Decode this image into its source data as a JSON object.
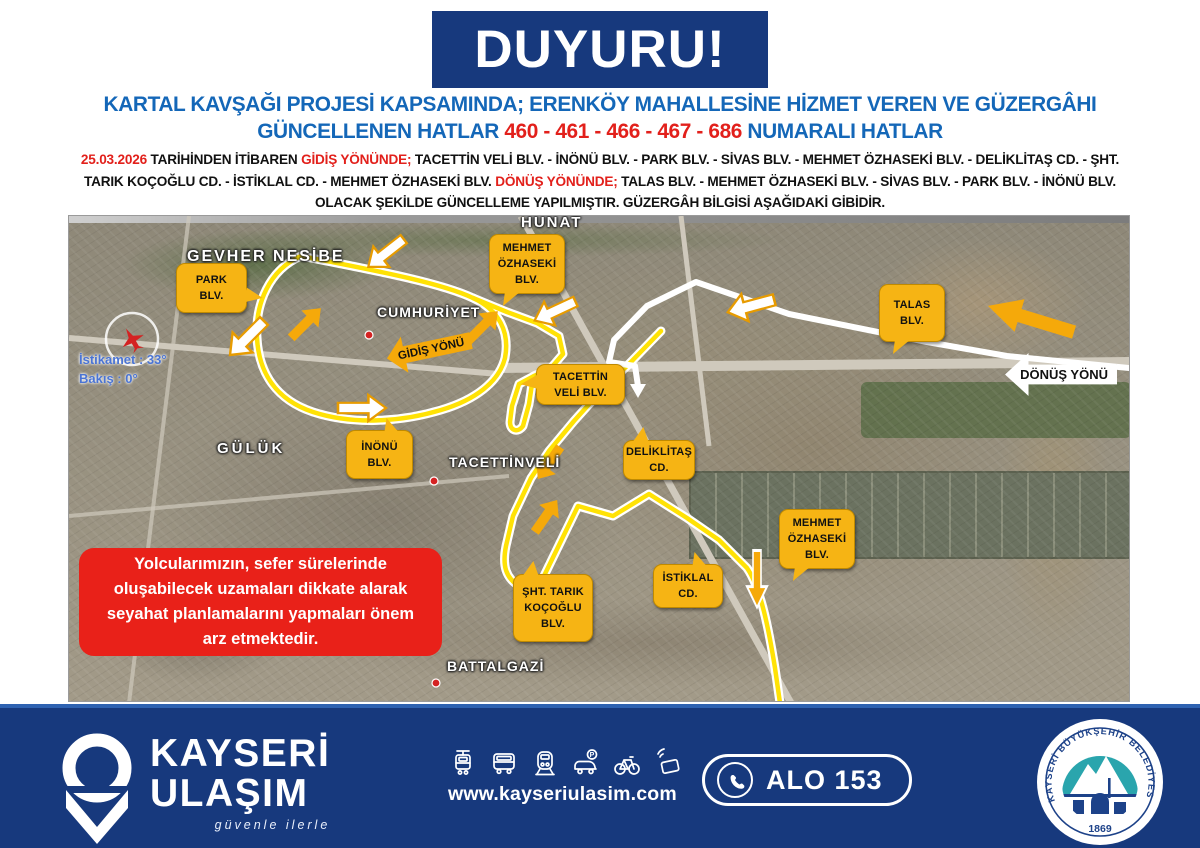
{
  "banner": {
    "title": "DUYURU!"
  },
  "headline": {
    "line1": "KARTAL KAVŞAĞI PROJESİ KAPSAMINDA; ERENKÖY MAHALLESİNE HİZMET VEREN VE GÜZERGÂHI",
    "line2_prefix": "GÜNCELLENEN HATLAR ",
    "line2_numbers": "460 - 461 - 466 - 467 - 686",
    "line2_suffix": " NUMARALI HATLAR"
  },
  "body": {
    "date": "25.03.2026",
    "seg_intro": " TARİHİNDEN İTİBAREN ",
    "gidis_label": "GİDİŞ YÖNÜNDE;",
    "gidis_route": " TACETTİN VELİ BLV. - İNÖNÜ BLV. - PARK BLV. - SİVAS BLV. - MEHMET ÖZHASEKİ BLV. - DELİKLİTAŞ CD. - ŞHT. TARIK KOÇOĞLU CD. - İSTİKLAL CD. - MEHMET ÖZHASEKİ BLV. ",
    "donus_label": "DÖNÜŞ YÖNÜNDE;",
    "donus_route": " TALAS BLV. - MEHMET ÖZHASEKİ BLV. - SİVAS BLV. - PARK BLV. - İNÖNÜ BLV. OLACAK ŞEKİLDE GÜNCELLEME YAPILMIŞTIR. GÜZERGÂH BİLGİSİ AŞAĞIDAKİ GİBİDİR."
  },
  "map": {
    "callouts": [
      {
        "text": "PARK\nBLV."
      },
      {
        "text": "MEHMET\nÖZHASEKİ\nBLV."
      },
      {
        "text": "TALAS\nBLV."
      },
      {
        "text": "TACETTİN\nVELİ BLV."
      },
      {
        "text": "İNÖNÜ\nBLV."
      },
      {
        "text": "DELİKLİTAŞ\nCD."
      },
      {
        "text": "İSTİKLAL\nCD."
      },
      {
        "text": "ŞHT. TARIK\nKOÇOĞLU\nBLV."
      },
      {
        "text": "MEHMET\nÖZHASEKİ\nBLV."
      }
    ],
    "place_labels": [
      {
        "text": "HUNAT"
      },
      {
        "text": "GEVHER NESİBE"
      },
      {
        "text": "CUMHURİYET"
      },
      {
        "text": "TACETTİNVELİ"
      },
      {
        "text": "GÜLÜK"
      },
      {
        "text": "BATTALGAZİ"
      }
    ],
    "direction_arrows": {
      "gidis": "GİDİŞ YÖNÜ",
      "donus": "DÖNÜŞ YÖNÜ"
    },
    "compass": {
      "line1": "İstikamet : 33°",
      "line2": "Bakış : 0°"
    },
    "warning": "Yolcularımızın, sefer sürelerinde oluşabilecek uzamaları dikkate alarak seyahat planlamalarını yapmaları önem arz etmektedir."
  },
  "footer": {
    "brand_line1": "KAYSERİ",
    "brand_line2": "ULAŞIM",
    "slogan": "güvenle ilerle",
    "website": "www.kayseriulasim.com",
    "phone_label": "ALO 153",
    "icons": [
      "tram",
      "bus",
      "train",
      "car-parking",
      "bicycle",
      "contactless-card"
    ],
    "seal": {
      "ring_text": "KAYSERİ BÜYÜKŞEHİR BELEDİYESİ",
      "year": "1869"
    }
  },
  "colors": {
    "navy": "#17397d",
    "headline_blue": "#1467b8",
    "accent_red": "#e2201b",
    "warning_red": "#e92119",
    "callout_amber": "#f6b414",
    "route_yellow": "#ffe205",
    "footer_stripe": "#2e62b1",
    "seal_teal": "#2aa5ad"
  }
}
